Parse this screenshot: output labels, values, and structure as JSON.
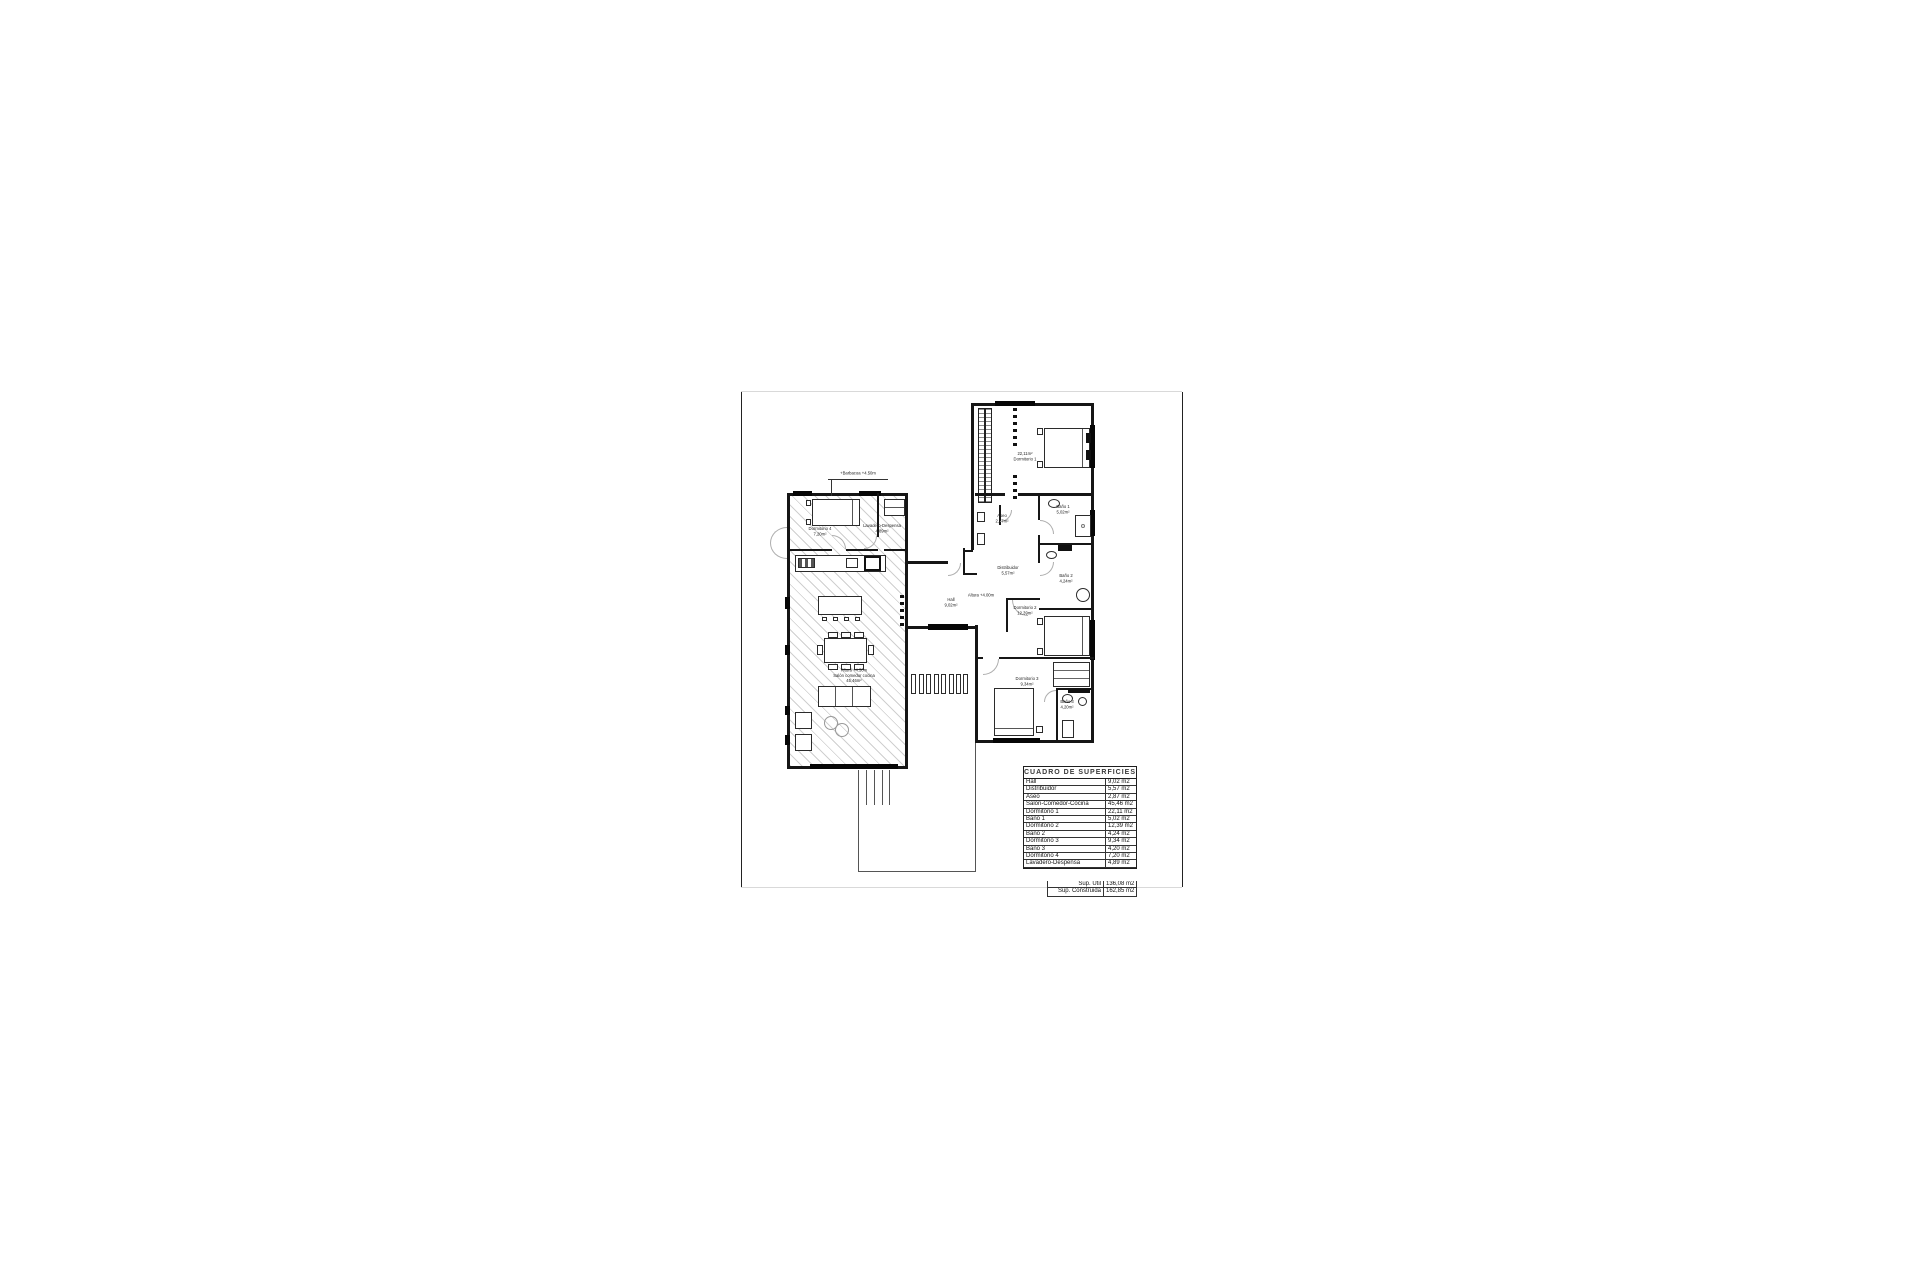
{
  "callout": {
    "text": "+Barbacoa +4.50m"
  },
  "rooms": [
    {
      "l1": "Dormitorio 4",
      "l2": "7,20m²"
    },
    {
      "l1": "Lavadero-Despensa",
      "l2": "4,89m²"
    },
    {
      "l1": "Altura +4.50m",
      "l2": "Salón comedor cocina",
      "l3": "45,46m²"
    },
    {
      "l1": "Hall",
      "l2": "9,02m²"
    },
    {
      "l1": "Altura +4.00m"
    },
    {
      "l1": "22,11m²",
      "l2": "Dormitorio 1"
    },
    {
      "l1": "Aseo",
      "l2": "2,87m²"
    },
    {
      "l1": "Baño 1",
      "l2": "5,02m²"
    },
    {
      "l1": "Distribuidor",
      "l2": "5,57m²"
    },
    {
      "l1": "Baño 2",
      "l2": "4,24m²"
    },
    {
      "l1": "Dormitorio 2",
      "l2": "12,39m²"
    },
    {
      "l1": "Dormitorio 3",
      "l2": "9,34m²"
    },
    {
      "l1": "Baño 3",
      "l2": "4,20m²"
    }
  ],
  "table": {
    "title": "CUADRO DE SUPERFICIES",
    "rows": [
      [
        "Hall",
        "9,02 m2"
      ],
      [
        "Distribuidor",
        "5,57 m2"
      ],
      [
        "Aseo",
        "2,87 m2"
      ],
      [
        "Salón-Comedor-Cocina",
        "45,46 m2"
      ],
      [
        "Dormitorio 1",
        "22,11 m2"
      ],
      [
        "Baño 1",
        "5,02 m2"
      ],
      [
        "Dormitorio 2",
        "12,39 m2"
      ],
      [
        "Baño 2",
        "4,24 m2"
      ],
      [
        "Dormitorio 3",
        "9,34 m2"
      ],
      [
        "Baño 3",
        "4,20 m2"
      ],
      [
        "Dormitorio 4",
        "7,20 m2"
      ],
      [
        "Lavadero-Despensa",
        "4,89 m2"
      ]
    ],
    "summary": [
      [
        "Sup. Útil",
        "136,08 m2"
      ],
      [
        "Sup. Construida",
        "162,85 m2"
      ]
    ]
  },
  "colors": {
    "line": "#161616",
    "window": "#060606",
    "hatch": "#828282",
    "arc": "#aeaeae"
  }
}
